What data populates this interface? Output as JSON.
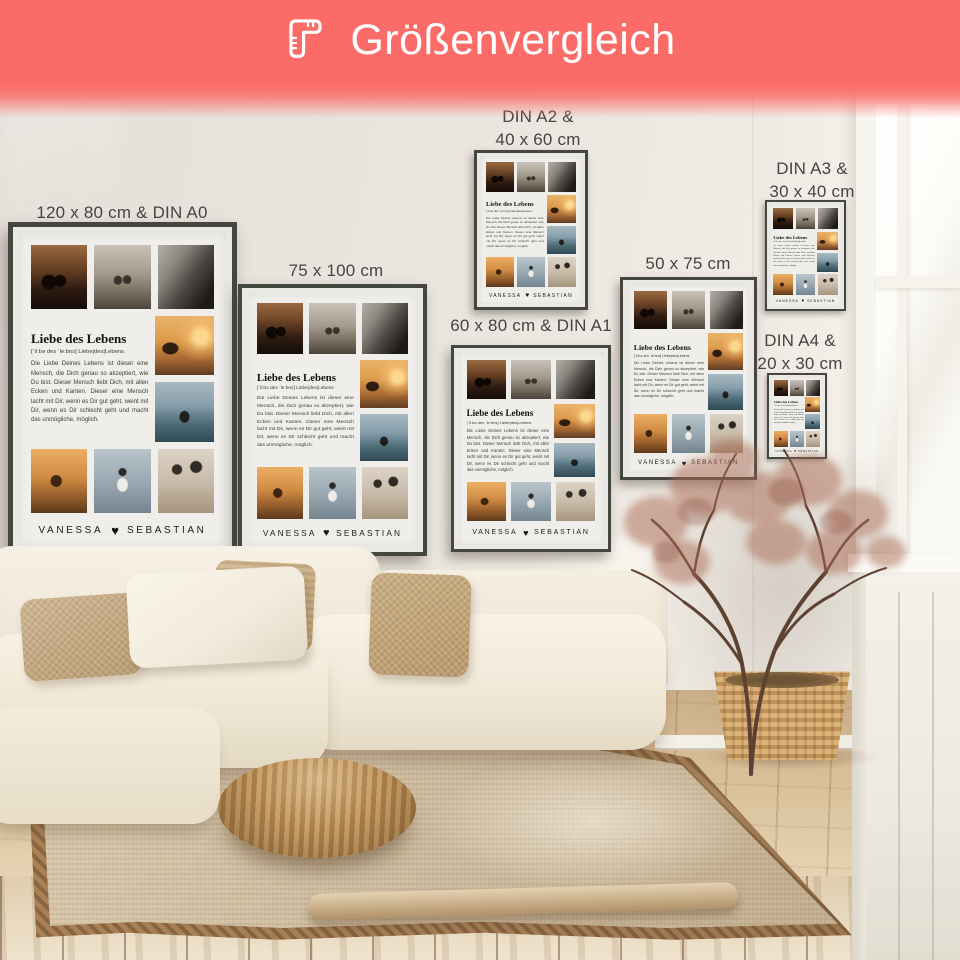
{
  "banner": {
    "title": "Größenvergleich",
    "icon": "corner-ruler-icon",
    "bg_color": "#fb6c68",
    "text_color": "#ffffff"
  },
  "poster": {
    "title": "Liebe des Lebens",
    "phonetic": "[ˈliːbə des ˈleːbns]  Liebe|des|Lebens",
    "body": "Die Liebe Deines Lebens ist dieser eine Mensch, die Dich genau so akzeptiert, wie Du bist. Dieser Mensch liebt Dich, mit allen Ecken und Kanten. Dieser eine Mensch lacht mit Dir, wenn es Dir gut geht, weint mit Dir, wenn es Dir schlecht geht und macht das unmögliche, möglich.",
    "names": {
      "left": "VANESSA",
      "heart": "♥",
      "right": "SEBASTIAN"
    },
    "photos": [
      "photo-sunset-silhouette-couple",
      "photo-mountain-walk-couple",
      "photo-closeup-portrait-bw",
      "photo-beach-sunset-couple",
      "photo-lake-view-couple",
      "photo-golden-hour-couple",
      "photo-beach-embrace-couple",
      "photo-face-to-face-couple"
    ]
  },
  "sizes": [
    {
      "id": "a0",
      "lines": [
        "120 x 80 cm & DIN A0"
      ]
    },
    {
      "id": "p75",
      "lines": [
        "75 x 100 cm"
      ]
    },
    {
      "id": "a2",
      "lines": [
        "DIN A2 &",
        "40 x 60 cm"
      ]
    },
    {
      "id": "a1",
      "lines": [
        "60 x 80 cm & DIN A1"
      ]
    },
    {
      "id": "p50",
      "lines": [
        "50 x 75 cm"
      ]
    },
    {
      "id": "a3",
      "lines": [
        "DIN A3 &",
        "30 x 40 cm"
      ]
    },
    {
      "id": "a4",
      "lines": [
        "DIN A4 &",
        "20 x 30 cm"
      ]
    }
  ],
  "colors": {
    "banner": "#fb6c68",
    "label_text": "#474441",
    "poster_frame": "#43473f",
    "poster_background": "#efeeea",
    "wall": "#eae6df",
    "sofa": "#f5efe2",
    "floor": "#d9c09a"
  }
}
